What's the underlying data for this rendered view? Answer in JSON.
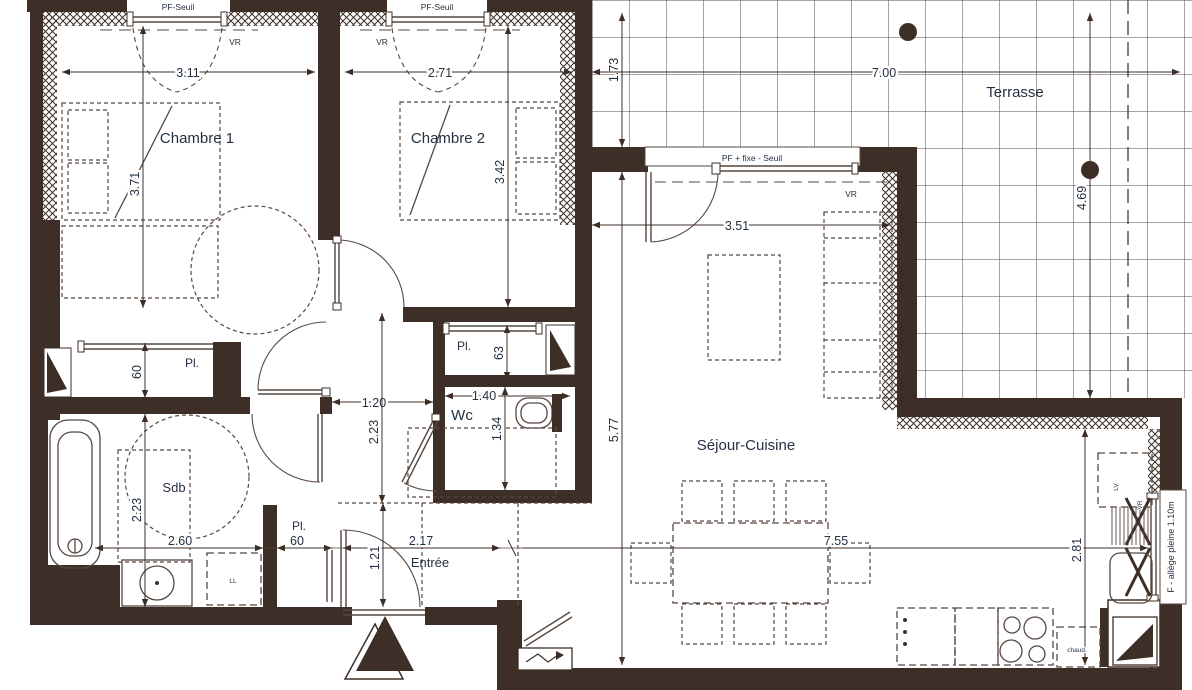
{
  "rooms": {
    "chambre1": {
      "label": "Chambre 1"
    },
    "chambre2": {
      "label": "Chambre 2"
    },
    "terrasse": {
      "label": "Terrasse"
    },
    "sejour": {
      "label": "Séjour-Cuisine"
    },
    "sdb": {
      "label": "Sdb"
    },
    "wc": {
      "label": "Wc"
    },
    "entree": {
      "label": "Entrée"
    },
    "placard1": {
      "label": "Pl."
    },
    "placard2": {
      "label": "Pl."
    },
    "placard3": {
      "label": "Pl."
    }
  },
  "dimensions": {
    "chambre1_width": "3.11",
    "chambre1_depth": "3.71",
    "chambre2_width": "2.71",
    "chambre2_depth": "3.42",
    "terrasse_depth_left": "1.73",
    "terrasse_width": "7.00",
    "terrasse_depth_right": "4.69",
    "sejour_door_width": "3.51",
    "sejour_depth": "5.77",
    "sejour_width": "7.55",
    "hall_width": "1.20",
    "hall_depth": "2.23",
    "wc_width": "1.40",
    "wc_depth": "1.34",
    "placard_mid_depth": "63",
    "placard_left_depth": "60",
    "placard_bottom_width": "60",
    "sdb_width": "2.60",
    "sdb_depth": "2.23",
    "entree_width": "2.17",
    "entree_depth": "1.21",
    "kitchen_depth": "2.81"
  },
  "annotations": {
    "window1": "PF-Seuil",
    "window2": "PF-Seuil",
    "vr1": "VR",
    "vr2": "VR",
    "vr3": "VR",
    "vr4": "VR",
    "bay": "PF + fixe - Seuil",
    "kitchen_window": "F - allège pleine 1.10m",
    "boiler": "chaud.",
    "washing_machine": "LL",
    "dishwasher": "LV"
  },
  "colors": {
    "wall": "#3d2f27",
    "line": "#564840",
    "text": "#243142"
  }
}
